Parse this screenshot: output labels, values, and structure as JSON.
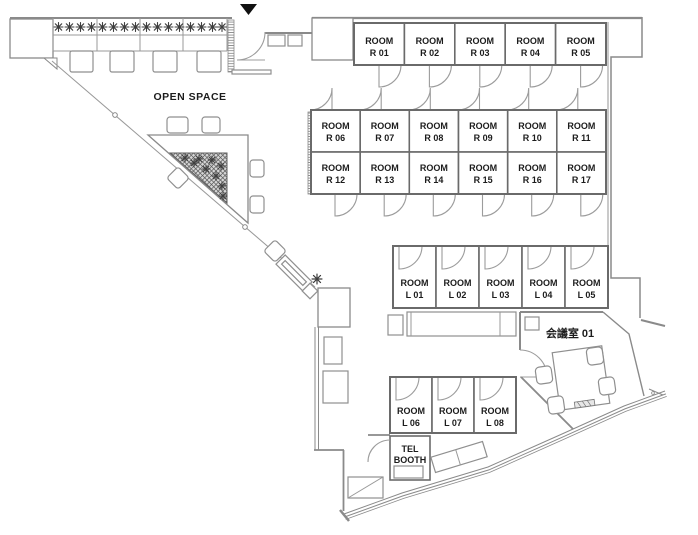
{
  "labels": {
    "open_space": "OPEN SPACE",
    "meeting_room": "会議室 01",
    "tel_line1": "TEL",
    "tel_line2": "BOOTH"
  },
  "icons": {
    "entrance_marker": "▼",
    "plant": "✳"
  },
  "rooms": {
    "r_top": [
      {
        "l1": "ROOM",
        "l2": "R 01"
      },
      {
        "l1": "ROOM",
        "l2": "R 02"
      },
      {
        "l1": "ROOM",
        "l2": "R 03"
      },
      {
        "l1": "ROOM",
        "l2": "R 04"
      },
      {
        "l1": "ROOM",
        "l2": "R 05"
      }
    ],
    "r_mid_upper": [
      {
        "l1": "ROOM",
        "l2": "R 06"
      },
      {
        "l1": "ROOM",
        "l2": "R 07"
      },
      {
        "l1": "ROOM",
        "l2": "R 08"
      },
      {
        "l1": "ROOM",
        "l2": "R 09"
      },
      {
        "l1": "ROOM",
        "l2": "R 10"
      },
      {
        "l1": "ROOM",
        "l2": "R 11"
      }
    ],
    "r_mid_lower": [
      {
        "l1": "ROOM",
        "l2": "R 12"
      },
      {
        "l1": "ROOM",
        "l2": "R 13"
      },
      {
        "l1": "ROOM",
        "l2": "R 14"
      },
      {
        "l1": "ROOM",
        "l2": "R 15"
      },
      {
        "l1": "ROOM",
        "l2": "R 16"
      },
      {
        "l1": "ROOM",
        "l2": "R 17"
      }
    ],
    "l_upper": [
      {
        "l1": "ROOM",
        "l2": "L 01"
      },
      {
        "l1": "ROOM",
        "l2": "L 02"
      },
      {
        "l1": "ROOM",
        "l2": "L 03"
      },
      {
        "l1": "ROOM",
        "l2": "L 04"
      },
      {
        "l1": "ROOM",
        "l2": "L 05"
      }
    ],
    "l_lower": [
      {
        "l1": "ROOM",
        "l2": "L 06"
      },
      {
        "l1": "ROOM",
        "l2": "L 07"
      },
      {
        "l1": "ROOM",
        "l2": "L 08"
      }
    ]
  },
  "colors": {
    "wall": "#8a8a8a",
    "room_border": "#6a6a6a",
    "door": "#9c9c9c",
    "text": "#1c1c1c",
    "marker": "#111111",
    "plant": "#3f3f3f",
    "background": "#ffffff"
  }
}
